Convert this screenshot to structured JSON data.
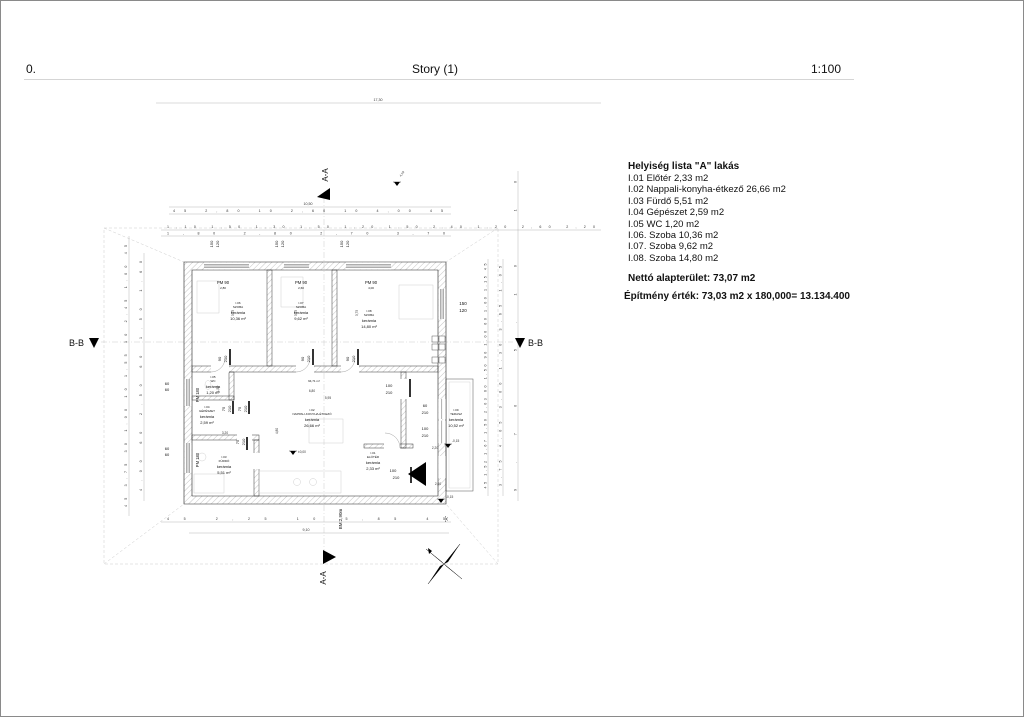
{
  "header": {
    "left": "0.",
    "center": "Story (1)",
    "right": "1:100"
  },
  "room_list": {
    "title": "Helyiség lista \"A\" lakás",
    "items": [
      "I.01 Előtér 2,33 m2",
      "I.02 Nappali-konyha-étkező 26,66 m2",
      "I.03 Fürdő 5,51 m2",
      "I.04 Gépészet 2,59 m2",
      "I.05 WC 1,20 m2",
      "I.06. Szoba 10,36 m2",
      "I.07. Szoba 9,62 m2",
      "I.08. Szoba 14,80 m2"
    ],
    "net_area": "Nettó alapterület: 73,07 m2",
    "value_line": "Építmény érték: 73,03 m2 x 180,000= 13.134.400"
  },
  "plan": {
    "rooms": [
      {
        "id": "I.06",
        "name": "SZOBA",
        "material": "kerámia",
        "area": "10,36 m²"
      },
      {
        "id": "I.07",
        "name": "SZOBA",
        "material": "kerámia",
        "area": "9,62 m²"
      },
      {
        "id": "I.08",
        "name": "SZOBA",
        "material": "kerámia",
        "area": "14,80 m²"
      },
      {
        "id": "I.05",
        "name": "WC",
        "material": "kerámia",
        "area": "1,20 m²"
      },
      {
        "id": "I.04",
        "name": "GÉPÉSZET",
        "material": "kerámia",
        "area": "2,59 m²"
      },
      {
        "id": "I.03",
        "name": "FÜRDŐ",
        "material": "kerámia",
        "area": "5,51 m²"
      },
      {
        "id": "I.02",
        "name": "NAPPALI-KONYHA-ÉTKEZŐ",
        "material": "kerámia",
        "area": "26,66 m²"
      },
      {
        "id": "I.01",
        "name": "ELŐTÉR",
        "material": "kerámia",
        "area": "2,33 m²"
      },
      {
        "id": "I.09",
        "name": "TERASZ",
        "material": "kerámia",
        "area": "10,52 m²"
      }
    ],
    "volume": "94,71 m³",
    "doors": [
      {
        "w": "90",
        "h": "210"
      },
      {
        "w": "90",
        "h": "210"
      },
      {
        "w": "90",
        "h": "210"
      },
      {
        "w": "75",
        "h": "210"
      },
      {
        "w": "75",
        "h": "210"
      },
      {
        "w": "75",
        "h": "210"
      },
      {
        "w": "100",
        "h": "210"
      },
      {
        "w": "100",
        "h": "210"
      },
      {
        "w": "60",
        "h": "210"
      },
      {
        "w": "100",
        "h": "210"
      }
    ],
    "windows": {
      "top_labels": [
        "PM 90",
        "PM 90",
        "PM 90"
      ],
      "top_dims": [
        "2,80",
        "2,60",
        "4,00"
      ],
      "left_labels": [
        "PM 180",
        "PM 180"
      ],
      "sill_w": "150",
      "sill_h": "120",
      "left_sill_w": "60",
      "left_sill_h": "60"
    },
    "dims": {
      "top_total": "17,30",
      "row1_total": "10,50",
      "row1": [
        "45",
        "2,80",
        "10",
        "2,60",
        "10",
        "4,00",
        "45"
      ],
      "row2": [
        "1,10",
        "1,50",
        "1,30",
        "1,50",
        "1,20",
        "1,50",
        "2,40",
        "1,20",
        "2,60",
        "2,20"
      ],
      "row2b": [
        "1,80",
        "2,80",
        "2,70",
        "3,70"
      ],
      "bottom": [
        "45",
        "2,25",
        "10",
        "5,85",
        "45"
      ],
      "bottom_total": "9,10",
      "left1": [
        "45",
        "3,75",
        "30",
        "1,00",
        "10",
        "1,55",
        "10",
        "2,45",
        "1,00",
        "45"
      ],
      "left2": [
        "4,00",
        "60",
        "2,50",
        "60",
        "1,50",
        "1,60"
      ],
      "right1": [
        "45",
        "1,52",
        "1,67",
        "1,50",
        "2,03",
        "60",
        "1,50",
        "90",
        "1,00",
        "60",
        "1,00",
        "1,15",
        "45"
      ],
      "right2": [
        "3,75",
        "4,05",
        "3,00",
        "1,30",
        "3,65",
        "1,05"
      ],
      "right3": [
        "9,70",
        "5,10",
        "10"
      ]
    },
    "inner_dims": [
      "3,75",
      "3,75",
      "3,75",
      "6,80",
      "5,95",
      "4,80",
      "2,20",
      "3,20",
      "2,60",
      "1,55"
    ],
    "levels": [
      "±0,00",
      "-0,15",
      "-0,15",
      "4,19"
    ],
    "sections": {
      "aa": "A-A",
      "bb": "B-B"
    },
    "misc": {
      "bm": "BM:2,90m",
      "a_tag": "\"A\""
    }
  }
}
